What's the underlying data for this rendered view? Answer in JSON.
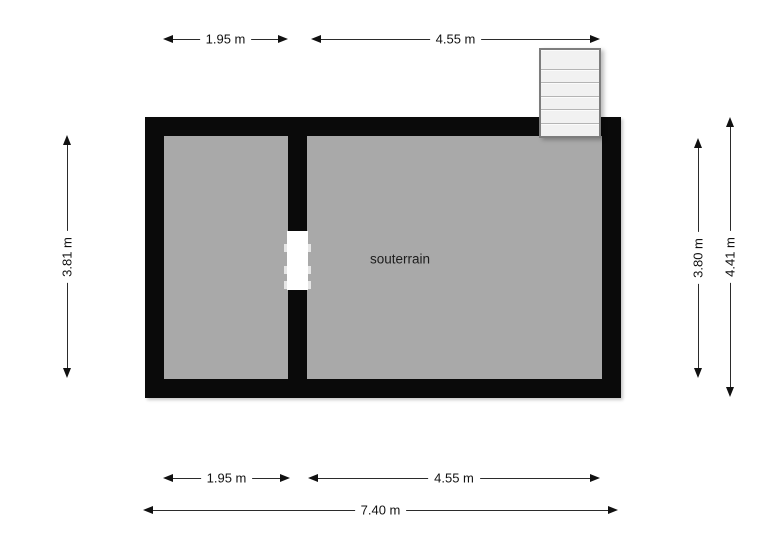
{
  "room": {
    "label": "souterrain"
  },
  "dims": {
    "top_left": "1.95 m",
    "top_right": "4.55 m",
    "left_inner": "3.81 m",
    "right_inner": "3.80 m",
    "right_outer": "4.41 m",
    "bottom_left": "1.95 m",
    "bottom_right": "4.55 m",
    "bottom_total": "7.40 m"
  },
  "icons": {
    "dimension_arrow": "double-headed-arrow",
    "staircase": "stair-treads"
  },
  "colors": {
    "background": "#ffffff",
    "wall": "#0a0a0a",
    "room_fill": "#a9a9a9",
    "stair_fill": "#f1f1f1",
    "stair_border": "#7d7d7d",
    "dim_line": "#2b2b2b",
    "text": "#111111"
  }
}
